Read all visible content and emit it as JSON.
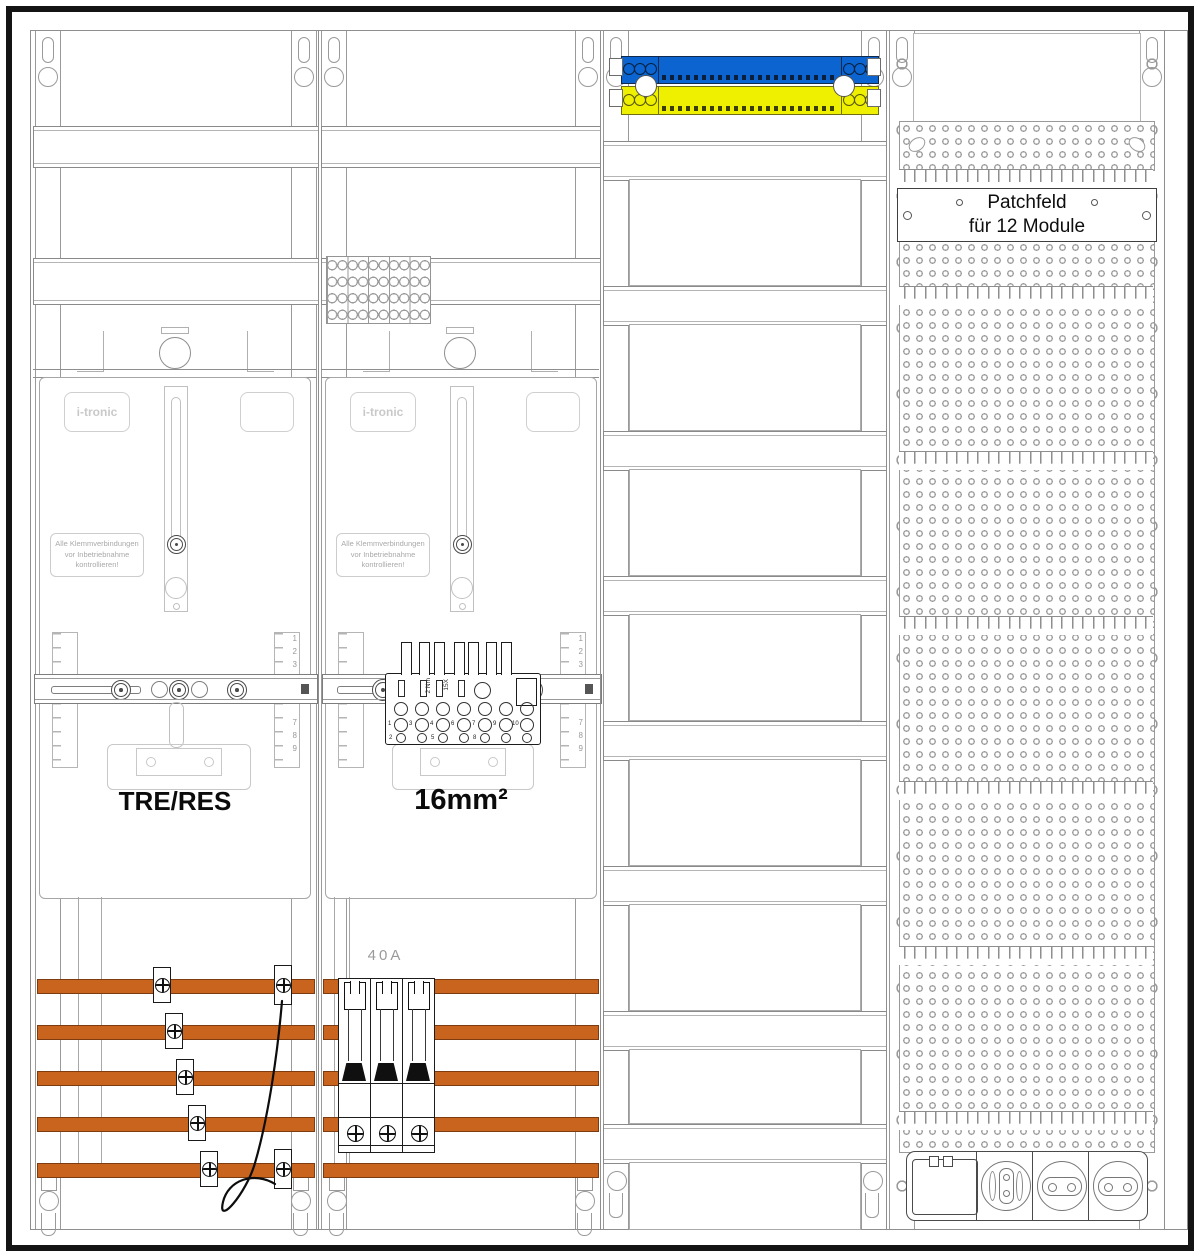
{
  "colors": {
    "busbar_orange": "#C8641E",
    "neutral_block_blue": "#0B64CF",
    "pe_block_yellow": "#EFEF00",
    "outline_gray": "#8E8E8E",
    "frame_black": "#141414"
  },
  "shared": {
    "brand": "i-tronic",
    "warning": [
      "Alle Klemmverbindungen",
      "vor Inbetriebnahme",
      "kontrollieren!"
    ],
    "ruler_top": [
      "1",
      "2",
      "3"
    ],
    "ruler_bottom": [
      "7",
      "8",
      "9"
    ]
  },
  "meter_field_1": {
    "label": "TRE/RES"
  },
  "meter_field_2": {
    "label": "16mm²",
    "breaker_label": "40A",
    "terminal_torque": "2 Nm",
    "terminal_mark": "15X",
    "terminal_numbers_row": [
      "1",
      "3",
      "4",
      "6",
      "7",
      "9",
      "10"
    ],
    "terminal_numbers_bottom": [
      "2",
      "5",
      "8"
    ]
  },
  "patch_field": {
    "label_line1": "Patchfeld",
    "label_line2": "für 12 Module"
  }
}
